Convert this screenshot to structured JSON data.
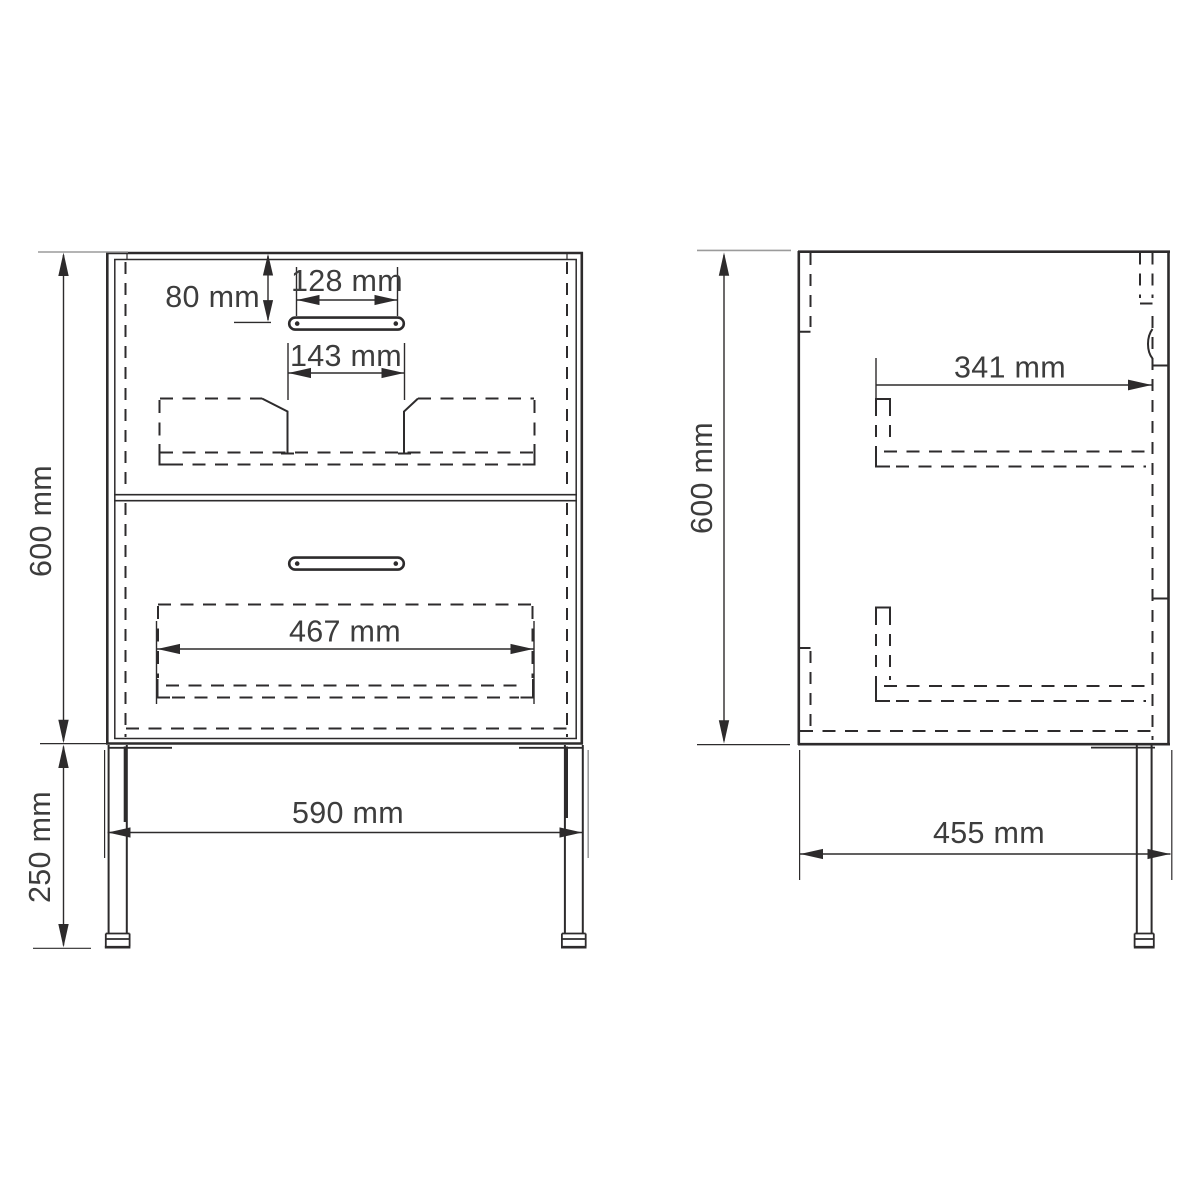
{
  "labels": {
    "front": {
      "top_to_handle": "80 mm",
      "handle_width": "128 mm",
      "handle_clearance": "143 mm",
      "body_height": "600 mm",
      "drawer_inner_width": "467 mm",
      "width": "590 mm",
      "leg_height": "250 mm"
    },
    "side": {
      "inner_depth": "341 mm",
      "body_height": "600 mm",
      "depth": "455 mm"
    }
  },
  "colors": {
    "line": "#2d2b2c",
    "dimension_tick_gray": "#9b9b9b",
    "text": "#3d3d3d",
    "background": "#ffffff"
  }
}
